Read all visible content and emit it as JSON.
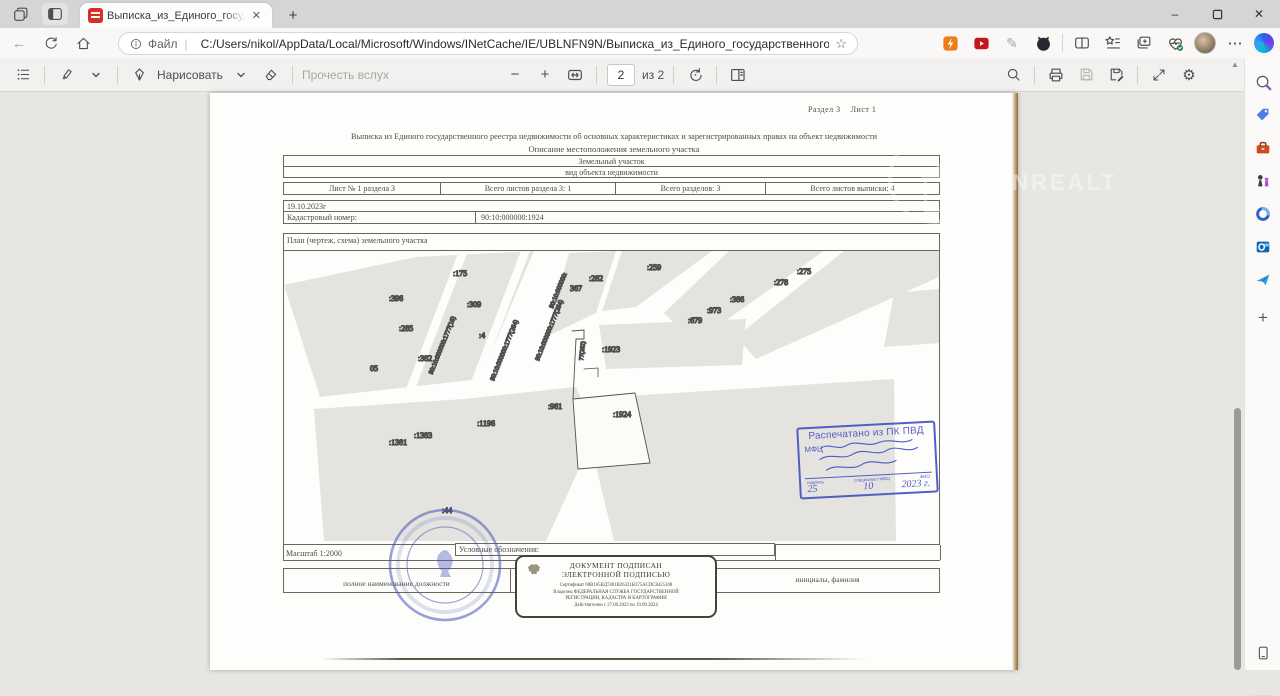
{
  "browser": {
    "tab_title": "Выписка_из_Единого_государст...",
    "url_prefix": "Файл",
    "url": "C:/Users/nikol/AppData/Local/Microsoft/Windows/INetCache/IE/UBLNFN9N/Выписка_из_Единого_государственного_...",
    "watermark": "ONREALT"
  },
  "icons": {
    "back": "←",
    "home": "⌂",
    "info": "i",
    "star": "☆",
    "more": "⋯",
    "close": "✕",
    "newtab": "+",
    "window_min": "–",
    "window_close": "✕",
    "minus": "−",
    "plus": "+",
    "gear": "⚙",
    "scroll_up": "▲",
    "pencil": "✎",
    "sidebar_plus": "+"
  },
  "pdf_toolbar": {
    "draw_label": "Нарисовать",
    "read_aloud_label": "Прочесть вслух",
    "page_number": "2",
    "page_total": "из 2"
  },
  "document": {
    "section_line": "Раздел 3    Лист 1",
    "title": "Выписка из Единого государственного реестра недвижимости об основных характеристиках и зарегистрированных правах на объект недвижимости",
    "subtitle": "Описание местоположения земельного участка",
    "object_type": "Земельный участок",
    "object_type_caption": "вид объекта недвижимости",
    "sheet_info": [
      "Лист № 1 раздела 3",
      "Всего листов раздела 3: 1",
      "Всего разделов: 3",
      "Всего листов выписки: 4"
    ],
    "date": "19.10.2023г",
    "cadastral_label": "Кадастровый номер:",
    "cadastral_number": "90:10:000000:1924",
    "plan_label": "План (чертеж, схема) земельного участка",
    "scale": "Масштаб 1:2000",
    "legend_label": "Условные обозначения:",
    "footer_position_label": "полное наименование должности",
    "footer_name_label": "инициалы, фамилия",
    "signature_stamp": {
      "line1": "ДОКУМЕНТ ПОДПИСАН",
      "line2": "ЭЛЕКТРОННОЙ ПОДПИСЬЮ",
      "certificate": "Сертификат 00B105BД7401B26321B375ACDC8425108",
      "owner1": "Владелец ФЕДЕРАЛЬНАЯ СЛУЖБА ГОСУДАРСТВЕННОЙ",
      "owner2": "РЕГИСТРАЦИИ, КАДАСТРА И КАРТОГРАФИИ",
      "validity": "Действителен с 27.06.2023 по 19.09.2024"
    },
    "print_stamp": {
      "line1": "Распечатано из ПК ПВД",
      "line2": "МФЦ",
      "sig_labels": [
        "подпись",
        "специалист МФЦ",
        "ФИО"
      ],
      "date_day": "25",
      "date_month": "10",
      "date_year": "2023 г."
    },
    "map": {
      "labels": [
        {
          "text": ":175",
          "x": 176,
          "y": 25
        },
        {
          "text": ":396",
          "x": 112,
          "y": 50
        },
        {
          "text": ":309",
          "x": 190,
          "y": 56
        },
        {
          "text": ":285",
          "x": 122,
          "y": 80
        },
        {
          "text": ":4",
          "x": 198,
          "y": 87
        },
        {
          "text": ":382",
          "x": 141,
          "y": 110
        },
        {
          "text": "05",
          "x": 90,
          "y": 120
        },
        {
          "text": ":282",
          "x": 312,
          "y": 30
        },
        {
          "text": ":259",
          "x": 370,
          "y": 19
        },
        {
          "text": "367",
          "x": 292,
          "y": 40
        },
        {
          "text": ":275",
          "x": 520,
          "y": 23
        },
        {
          "text": ":278",
          "x": 497,
          "y": 34
        },
        {
          "text": ":386",
          "x": 453,
          "y": 51
        },
        {
          "text": ":973",
          "x": 430,
          "y": 62
        },
        {
          "text": ":679",
          "x": 411,
          "y": 72
        },
        {
          "text": ":1923",
          "x": 327,
          "y": 101
        },
        {
          "text": ":961",
          "x": 271,
          "y": 158
        },
        {
          "text": ":1196",
          "x": 202,
          "y": 175
        },
        {
          "text": ":1383",
          "x": 139,
          "y": 187
        },
        {
          "text": ":1381",
          "x": 114,
          "y": 194
        },
        {
          "text": ":1924",
          "x": 338,
          "y": 166
        },
        {
          "text": ":44",
          "x": 163,
          "y": 262
        },
        {
          "text": "90:10:000000:1777(16)",
          "x": 160,
          "y": 95,
          "r": -68,
          "s": 6.5
        },
        {
          "text": "90:10:000000:1777(264)",
          "x": 222,
          "y": 100,
          "r": -68,
          "s": 6.5
        },
        {
          "text": "90:10:000000:1777(264)",
          "x": 267,
          "y": 80,
          "r": -68,
          "s": 6.5
        },
        {
          "text": "90:10:000000:",
          "x": 276,
          "y": 40,
          "r": -68,
          "s": 6.5
        },
        {
          "text": "77(262)",
          "x": 300,
          "y": 100,
          "r": -84,
          "s": 6
        }
      ]
    }
  }
}
